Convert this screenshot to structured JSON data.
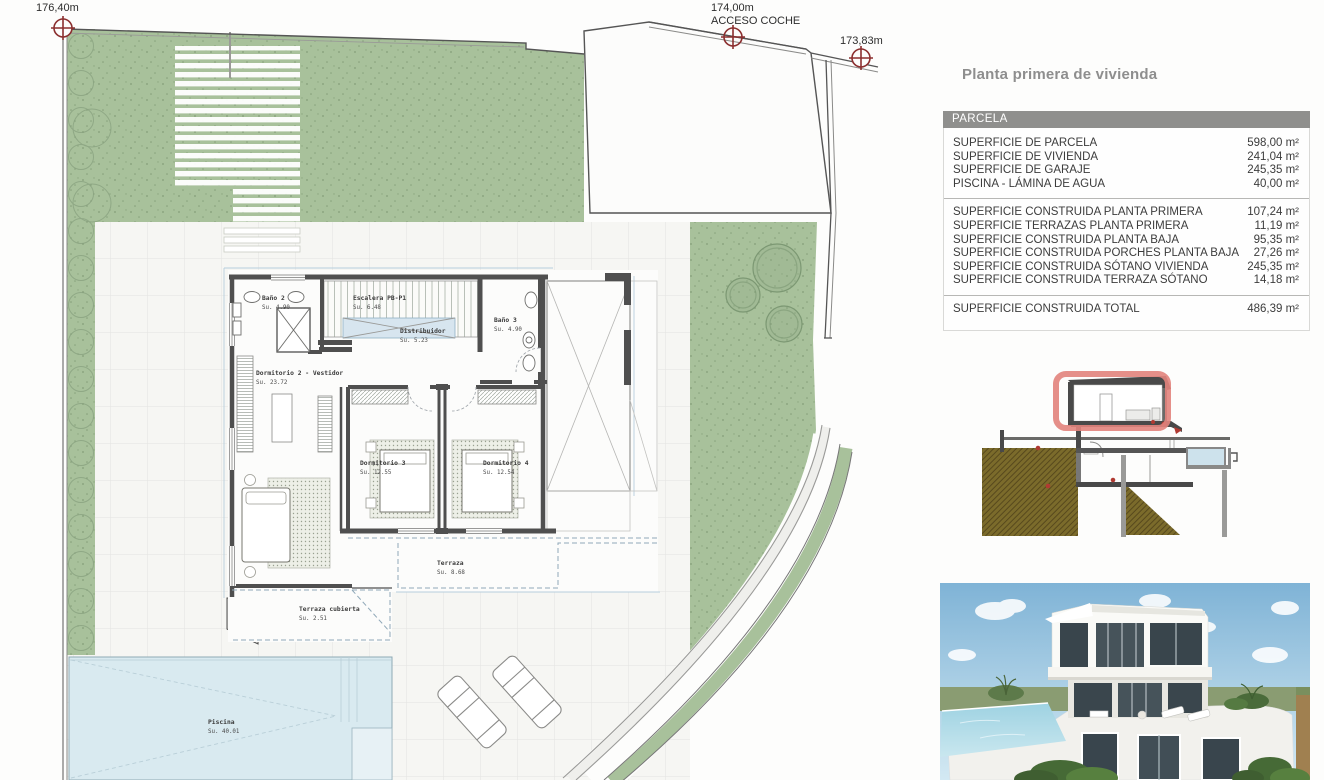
{
  "title": "Planta primera de vivienda",
  "site": {
    "markers": [
      {
        "elev": "176,40m",
        "note": ""
      },
      {
        "elev": "174,00m",
        "note": "ACCESO COCHE"
      },
      {
        "elev": "173,83m",
        "note": ""
      }
    ],
    "rooms": {
      "bano2": {
        "name": "Baño 2",
        "area": "Su. 4.90"
      },
      "escalera": {
        "name": "Escalera PB-P1",
        "area": "Su. 6.48"
      },
      "bano3": {
        "name": "Baño 3",
        "area": "Su. 4.90"
      },
      "distribuidor": {
        "name": "Distribuidor",
        "area": "Su. 5.23"
      },
      "dorm2": {
        "name": "Dormitorio 2 - Vestidor",
        "area": "Su. 23.72"
      },
      "dorm3": {
        "name": "Dormitorio 3",
        "area": "Su. 12.55"
      },
      "dorm4": {
        "name": "Dormitorio 4",
        "area": "Su. 12.54"
      },
      "terraza": {
        "name": "Terraza",
        "area": "Su. 8.68"
      },
      "terraza_cubierta": {
        "name": "Terraza cubierta",
        "area": "Su. 2.51"
      },
      "piscina": {
        "name": "Piscina",
        "area": "Su. 40.01"
      }
    }
  },
  "table": {
    "header": "PARCELA",
    "group1": [
      {
        "label": "SUPERFICIE DE PARCELA",
        "value": "598,00 m²"
      },
      {
        "label": "SUPERFICIE DE VIVIENDA",
        "value": "241,04 m²"
      },
      {
        "label": "SUPERFICIE DE GARAJE",
        "value": "245,35 m²"
      },
      {
        "label": "PISCINA - LÁMINA DE AGUA",
        "value": "40,00 m²"
      }
    ],
    "group2": [
      {
        "label": "SUPERFICIE CONSTRUIDA PLANTA PRIMERA",
        "value": "107,24 m²"
      },
      {
        "label": "SUPERFICIE TERRAZAS PLANTA PRIMERA",
        "value": "11,19 m²"
      },
      {
        "label": "SUPERFICIE CONSTRUIDA PLANTA BAJA",
        "value": "95,35 m²"
      },
      {
        "label": "SUPERFICIE CONSTRUIDA PORCHES PLANTA BAJA",
        "value": "27,26 m²"
      },
      {
        "label": "SUPERFICIE CONSTRUIDA SÓTANO VIVIENDA",
        "value": "245,35 m²"
      },
      {
        "label": "SUPERFICIE CONSTRUIDA TERRAZA SÓTANO",
        "value": "14,18 m²"
      }
    ],
    "total": {
      "label": "SUPERFICIE CONSTRUIDA TOTAL",
      "value": "486,39 m²"
    }
  },
  "colors": {
    "garden": "#a8c19b",
    "pool": "#d9eaf0",
    "wall": "#4f4f4f",
    "marker": "#8b2f2f",
    "highlight": "#e2837c"
  }
}
